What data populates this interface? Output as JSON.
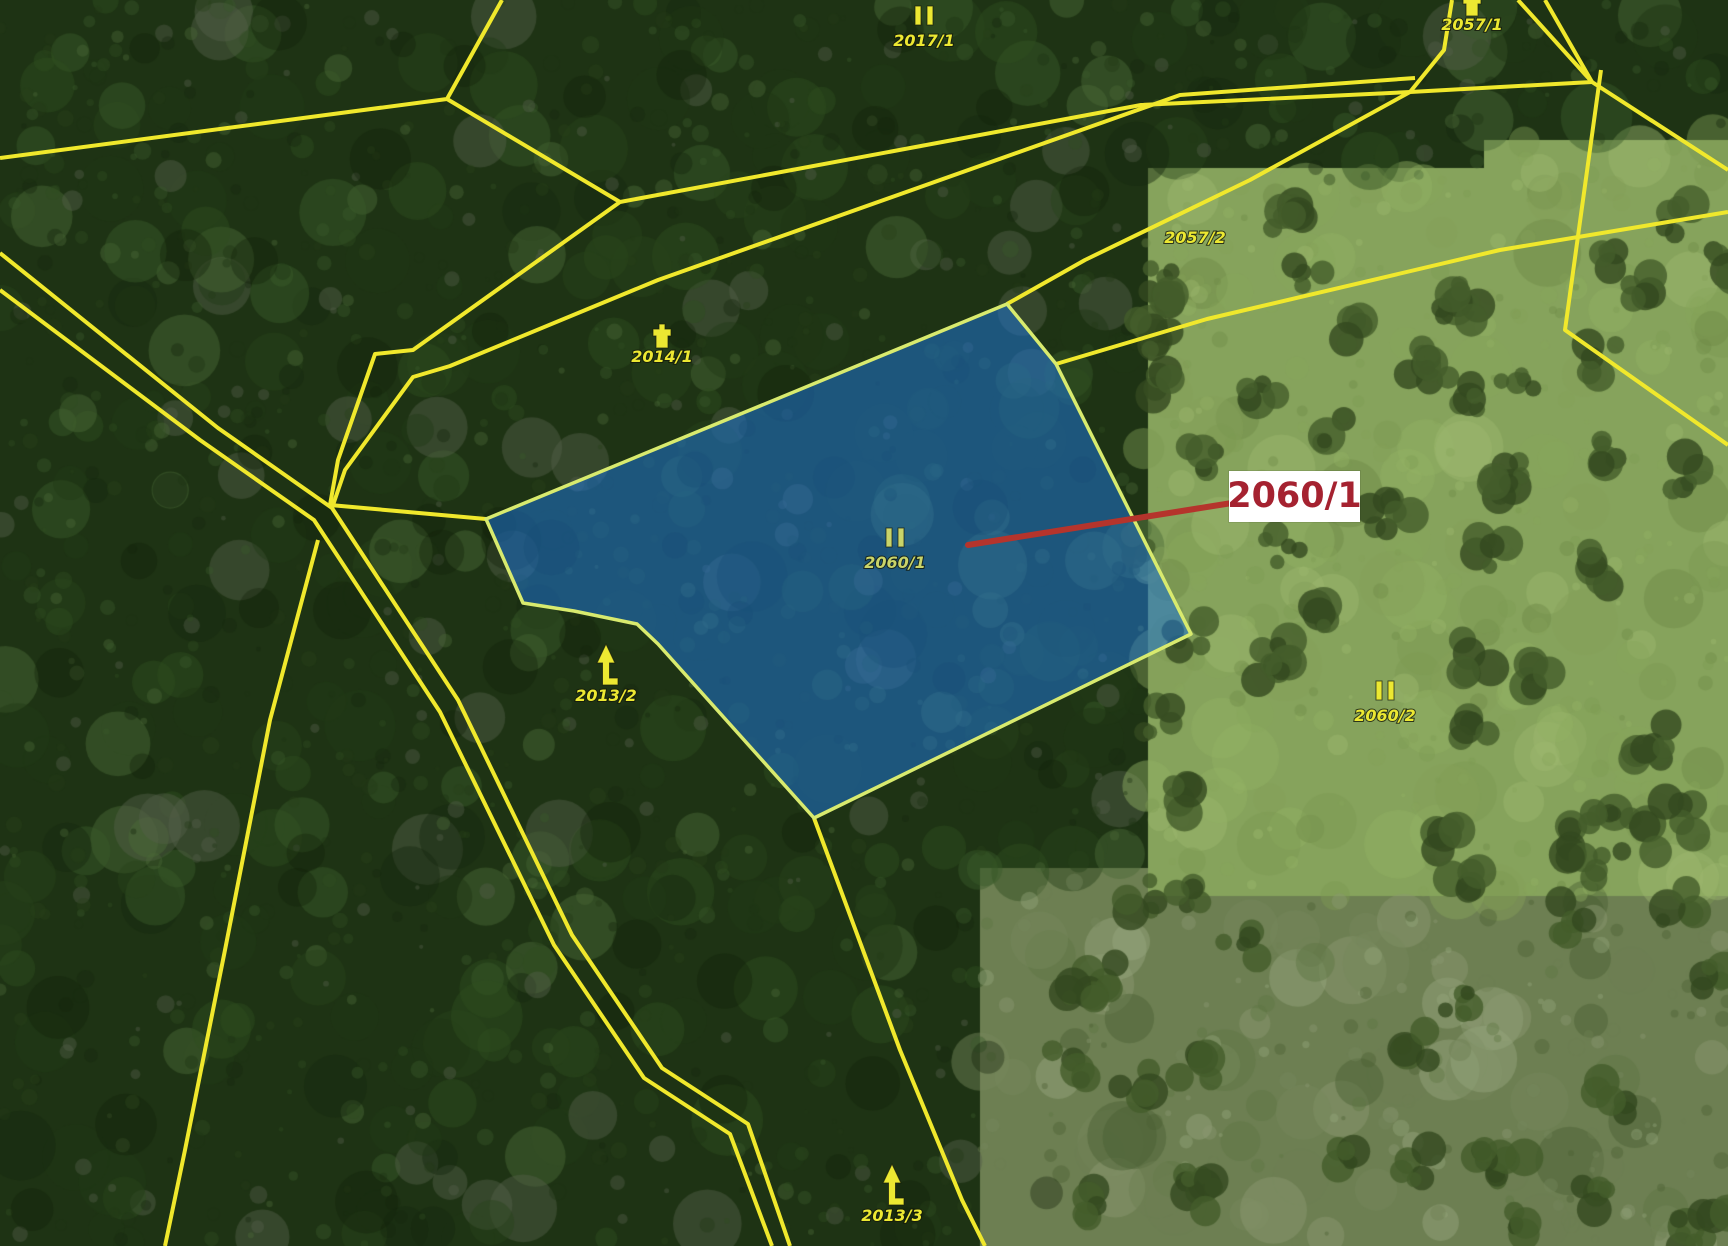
{
  "app": {
    "type": "cadastral-map-viewer",
    "view": "aerial-orthophoto-with-parcel-overlay"
  },
  "map": {
    "size": {
      "width": 1728,
      "height": 1246
    },
    "colors": {
      "boundary": "#f0e82c",
      "label_text": "#ece832",
      "label_text_on_selection": "#c9d46a",
      "selection_fill": "#1e73d2",
      "selection_fill_opacity": 0.55,
      "selection_stroke": "#d8ea6e",
      "callout_text": "#a52230",
      "callout_bg": "#ffffff",
      "leader_line": "#b5342c"
    },
    "selected_parcel": {
      "id": "2060/1",
      "polygon": [
        [
          486,
          519
        ],
        [
          1007,
          304
        ],
        [
          1056,
          364
        ],
        [
          1191,
          634
        ],
        [
          814,
          818
        ],
        [
          658,
          644
        ],
        [
          637,
          624
        ],
        [
          574,
          611
        ],
        [
          523,
          603
        ]
      ]
    },
    "callout": {
      "label": "2060/1",
      "box": {
        "x": 1229,
        "y": 471,
        "w": 131,
        "h": 51
      },
      "leader": {
        "x1": 968,
        "y1": 545,
        "x2": 1232,
        "y2": 503
      }
    },
    "labels": [
      {
        "id": "2017/1",
        "x": 924,
        "y": 46,
        "symbol": "meadow"
      },
      {
        "id": "2057/1",
        "x": 1472,
        "y": 30,
        "symbol": "building"
      },
      {
        "id": "2057/2",
        "x": 1195,
        "y": 243,
        "symbol": null
      },
      {
        "id": "2014/1",
        "x": 662,
        "y": 362,
        "symbol": "building"
      },
      {
        "id": "2060/1",
        "x": 895,
        "y": 568,
        "symbol": "meadow",
        "on_selection": true
      },
      {
        "id": "2060/2",
        "x": 1385,
        "y": 721,
        "symbol": "meadow"
      },
      {
        "id": "2013/2",
        "x": 606,
        "y": 701,
        "symbol": "conifer"
      },
      {
        "id": "2013/3",
        "x": 892,
        "y": 1221,
        "symbol": "conifer"
      }
    ],
    "boundary_lines": [
      [
        [
          0,
          158
        ],
        [
          447,
          99
        ],
        [
          502,
          0
        ]
      ],
      [
        [
          447,
          99
        ],
        [
          620,
          202
        ]
      ],
      [
        [
          1410,
          92
        ],
        [
          1141,
          105
        ],
        [
          620,
          202
        ],
        [
          413,
          350
        ],
        [
          375,
          354
        ],
        [
          338,
          460
        ],
        [
          330,
          505
        ]
      ],
      [
        [
          1415,
          78
        ],
        [
          1180,
          95
        ],
        [
          658,
          280
        ],
        [
          450,
          366
        ],
        [
          413,
          377
        ],
        [
          345,
          470
        ],
        [
          332,
          508
        ]
      ],
      [
        [
          486,
          519
        ],
        [
          330,
          505
        ]
      ],
      [
        [
          0,
          253
        ],
        [
          218,
          428
        ],
        [
          332,
          508
        ],
        [
          458,
          700
        ],
        [
          572,
          935
        ],
        [
          662,
          1068
        ],
        [
          748,
          1124
        ],
        [
          790,
          1246
        ]
      ],
      [
        [
          0,
          290
        ],
        [
          200,
          440
        ],
        [
          314,
          520
        ],
        [
          440,
          712
        ],
        [
          554,
          945
        ],
        [
          644,
          1078
        ],
        [
          730,
          1134
        ],
        [
          772,
          1246
        ]
      ],
      [
        [
          318,
          540
        ],
        [
          270,
          720
        ],
        [
          225,
          950
        ],
        [
          185,
          1150
        ],
        [
          165,
          1246
        ]
      ],
      [
        [
          814,
          818
        ],
        [
          900,
          1050
        ],
        [
          962,
          1200
        ],
        [
          985,
          1246
        ]
      ],
      [
        [
          1410,
          92
        ],
        [
          1250,
          180
        ],
        [
          1085,
          260
        ],
        [
          1007,
          304
        ]
      ],
      [
        [
          1056,
          364
        ],
        [
          1207,
          319
        ],
        [
          1500,
          250
        ],
        [
          1728,
          212
        ]
      ],
      [
        [
          1452,
          0
        ],
        [
          1444,
          50
        ],
        [
          1410,
          92
        ]
      ],
      [
        [
          1410,
          92
        ],
        [
          1592,
          82
        ],
        [
          1545,
          0
        ]
      ],
      [
        [
          1518,
          0
        ],
        [
          1592,
          82
        ]
      ],
      [
        [
          1592,
          82
        ],
        [
          1728,
          170
        ]
      ],
      [
        [
          1601,
          70
        ],
        [
          1565,
          330
        ],
        [
          1728,
          445
        ]
      ]
    ]
  }
}
